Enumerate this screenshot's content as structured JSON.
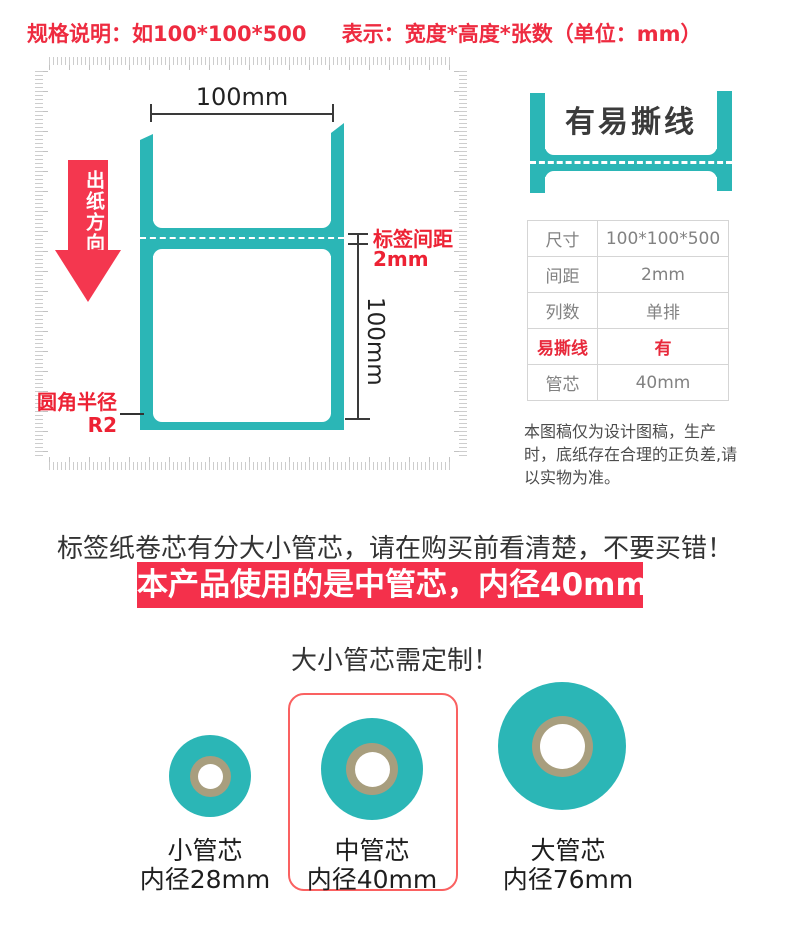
{
  "colors": {
    "teal": "#2bb6b6",
    "accent_red": "#f4304b",
    "label_red": "#ed2234",
    "core_ring_tan": "#a89e7e",
    "table_border": "#d5d5d5"
  },
  "header": {
    "spec_format": "规格说明：如100*100*500",
    "spec_meaning": "表示：宽度*高度*张数（单位：mm）"
  },
  "diagram": {
    "width_label": "100mm",
    "height_label": "100mm",
    "gap_label": "标签间距",
    "gap_value": "2mm",
    "corner_label": "圆角半径",
    "corner_value": "R2",
    "arrow_label": "出纸方向"
  },
  "tear_demo": {
    "label": "有易撕线"
  },
  "spec_table": {
    "rows": [
      {
        "key": "尺寸",
        "value": "100*100*500"
      },
      {
        "key": "间距",
        "value": "2mm"
      },
      {
        "key": "列数",
        "value": "单排"
      },
      {
        "key": "易撕线",
        "value": "有"
      },
      {
        "key": "管芯",
        "value": "40mm"
      }
    ],
    "note": "本图稿仅为设计图稿，生产时，底纸存在合理的正负差,请以实物为准。"
  },
  "core_section": {
    "headline": "标签纸卷芯有分大小管芯，请在购买前看清楚，不要买错！",
    "banner": "本产品使用的是中管芯，内径40mm",
    "subline": "大小管芯需定制！",
    "cores": [
      {
        "name": "小管芯",
        "size": "内径28mm",
        "selected": false
      },
      {
        "name": "中管芯",
        "size": "内径40mm",
        "selected": true
      },
      {
        "name": "大管芯",
        "size": "内径76mm",
        "selected": false
      }
    ]
  }
}
